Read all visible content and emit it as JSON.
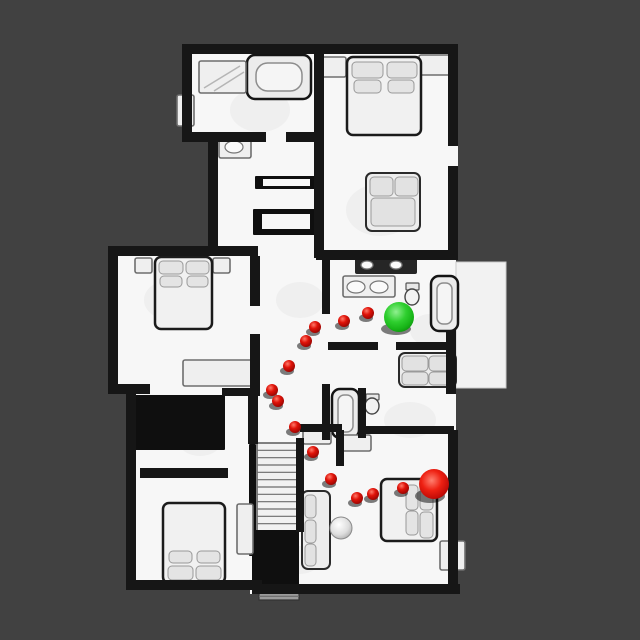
{
  "scene": {
    "background_color": "#414141",
    "canvas": {
      "width": 640,
      "height": 640
    }
  },
  "palette": {
    "floor": "#f7f7f7",
    "patio_floor": "#f2f2f2",
    "wall": "#161616",
    "furniture_fill": "#efefef",
    "furniture_stroke": "#6e6e6e",
    "bed_stroke": "#1b1b1b",
    "pillow_fill": "#e4e4e4",
    "pillow_stroke": "#999999",
    "dark_fill": "#0f0f0f",
    "tread_fill": "#f1f1f1",
    "smudge_fill": "#ebebeb",
    "waypoint_red": "#e01309",
    "waypoint_red_light": "#ff7a6a",
    "waypoint_red_dark": "#8f0503",
    "goal_red": "#dd1310",
    "start_green": "#2fcf2f",
    "start_green_light": "#90f090",
    "start_green_dark": "#0c8c0c",
    "shadow": "rgba(0,0,0,0.5)"
  },
  "markers": {
    "start": {
      "label": "start-position",
      "x": 399,
      "y": 317,
      "r": 15
    },
    "goal": {
      "label": "goal-position",
      "x": 434,
      "y": 484,
      "r": 15
    },
    "waypoint_radius": 6,
    "waypoints": [
      {
        "x": 368,
        "y": 313
      },
      {
        "x": 344,
        "y": 321
      },
      {
        "x": 315,
        "y": 327
      },
      {
        "x": 306,
        "y": 341
      },
      {
        "x": 289,
        "y": 366
      },
      {
        "x": 272,
        "y": 390
      },
      {
        "x": 278,
        "y": 401
      },
      {
        "x": 295,
        "y": 427
      },
      {
        "x": 313,
        "y": 452
      },
      {
        "x": 331,
        "y": 479
      },
      {
        "x": 357,
        "y": 498
      },
      {
        "x": 373,
        "y": 494
      },
      {
        "x": 403,
        "y": 488
      }
    ]
  },
  "floorplan": {
    "footprint": [
      [
        182,
        44,
        142,
        98
      ],
      [
        208,
        132,
        112,
        126
      ],
      [
        316,
        44,
        142,
        216
      ],
      [
        108,
        246,
        150,
        148
      ],
      [
        250,
        255,
        206,
        177
      ],
      [
        126,
        392,
        134,
        198
      ],
      [
        250,
        430,
        208,
        164
      ]
    ],
    "patio": [
      456,
      262,
      50,
      126
    ],
    "smudges": [
      [
        260,
        110,
        30,
        22
      ],
      [
        380,
        210,
        34,
        26
      ],
      [
        170,
        300,
        26,
        20
      ],
      [
        300,
        300,
        24,
        18
      ],
      [
        200,
        440,
        22,
        16
      ],
      [
        410,
        420,
        26,
        18
      ],
      [
        300,
        560,
        20,
        14
      ],
      [
        430,
        330,
        20,
        16
      ]
    ],
    "walls": [
      [
        182,
        44,
        142,
        10
      ],
      [
        182,
        44,
        10,
        96
      ],
      [
        182,
        132,
        36,
        10
      ],
      [
        208,
        138,
        10,
        118
      ],
      [
        214,
        132,
        52,
        10
      ],
      [
        286,
        132,
        38,
        10
      ],
      [
        316,
        44,
        142,
        10
      ],
      [
        448,
        44,
        10,
        102
      ],
      [
        448,
        166,
        10,
        94
      ],
      [
        314,
        50,
        10,
        90
      ],
      [
        314,
        140,
        10,
        118
      ],
      [
        316,
        250,
        140,
        10
      ],
      [
        108,
        246,
        150,
        10
      ],
      [
        108,
        246,
        10,
        148
      ],
      [
        108,
        384,
        42,
        10
      ],
      [
        250,
        256,
        10,
        50
      ],
      [
        250,
        334,
        10,
        62
      ],
      [
        446,
        330,
        10,
        64
      ],
      [
        322,
        258,
        8,
        56
      ],
      [
        328,
        342,
        50,
        8
      ],
      [
        396,
        342,
        58,
        8
      ],
      [
        300,
        424,
        42,
        8
      ],
      [
        360,
        426,
        94,
        8
      ],
      [
        322,
        384,
        8,
        56
      ],
      [
        358,
        388,
        8,
        50
      ],
      [
        448,
        430,
        10,
        160
      ],
      [
        252,
        584,
        208,
        10
      ],
      [
        126,
        392,
        10,
        198
      ],
      [
        126,
        580,
        136,
        10
      ],
      [
        140,
        468,
        88,
        10
      ],
      [
        296,
        438,
        8,
        94
      ],
      [
        222,
        388,
        38,
        8
      ],
      [
        248,
        392,
        10,
        52
      ],
      [
        336,
        430,
        8,
        36
      ]
    ],
    "furniture": [
      {
        "name": "bathtub-top-left",
        "kind": "tub",
        "x": 247,
        "y": 55,
        "w": 64,
        "h": 44,
        "inner": [
          256,
          63,
          46,
          28
        ]
      },
      {
        "name": "shower-top-left",
        "kind": "box",
        "x": 199,
        "y": 61,
        "w": 47,
        "h": 32,
        "lines": [
          [
            204,
            88,
            240,
            66
          ],
          [
            214,
            91,
            244,
            72
          ]
        ]
      },
      {
        "name": "cabinet-left-wall",
        "kind": "box",
        "x": 177,
        "y": 95,
        "w": 17,
        "h": 31
      },
      {
        "name": "vanity-top-left",
        "kind": "box",
        "x": 219,
        "y": 136,
        "w": 32,
        "h": 22,
        "ovals": [
          [
            234,
            147,
            9,
            6
          ]
        ]
      },
      {
        "name": "nightstand-master-left",
        "kind": "box",
        "x": 320,
        "y": 57,
        "w": 26,
        "h": 20
      },
      {
        "name": "nightstand-master-right",
        "kind": "box",
        "x": 419,
        "y": 55,
        "w": 34,
        "h": 20
      },
      {
        "name": "bed-master",
        "kind": "bed",
        "x": 347,
        "y": 57,
        "w": 74,
        "h": 78,
        "pillows": [
          [
            352,
            62,
            31,
            16
          ],
          [
            387,
            62,
            30,
            16
          ],
          [
            354,
            80,
            27,
            13
          ],
          [
            388,
            80,
            26,
            13
          ]
        ]
      },
      {
        "name": "armchair-master",
        "kind": "sofa",
        "x": 366,
        "y": 173,
        "w": 54,
        "h": 58,
        "cushions": [
          [
            370,
            177,
            23,
            19
          ],
          [
            395,
            177,
            23,
            19
          ],
          [
            371,
            198,
            44,
            28
          ]
        ]
      },
      {
        "name": "closet-door-frame-1",
        "kind": "frame",
        "x": 255,
        "y": 176,
        "w": 64,
        "h": 13,
        "inner": [
          263,
          179,
          47,
          7
        ]
      },
      {
        "name": "closet-door-frame-2",
        "kind": "frame",
        "x": 253,
        "y": 209,
        "w": 67,
        "h": 26,
        "inner": [
          262,
          214,
          48,
          15
        ]
      },
      {
        "name": "nightstand-left-room-a",
        "kind": "box",
        "x": 135,
        "y": 258,
        "w": 17,
        "h": 15
      },
      {
        "name": "nightstand-left-room-b",
        "kind": "box",
        "x": 213,
        "y": 258,
        "w": 17,
        "h": 15
      },
      {
        "name": "bed-left-room",
        "kind": "bed",
        "x": 155,
        "y": 257,
        "w": 57,
        "h": 72,
        "pillows": [
          [
            159,
            261,
            24,
            13
          ],
          [
            186,
            261,
            23,
            13
          ],
          [
            160,
            276,
            22,
            11
          ],
          [
            187,
            276,
            21,
            11
          ]
        ]
      },
      {
        "name": "dresser-left-room",
        "kind": "box",
        "x": 183,
        "y": 360,
        "w": 75,
        "h": 26
      },
      {
        "name": "counter-bedroom-side",
        "kind": "counter",
        "x": 355,
        "y": 257,
        "w": 62,
        "h": 17,
        "ovals": [
          [
            367,
            265,
            6,
            4
          ],
          [
            396,
            265,
            6,
            4
          ]
        ]
      },
      {
        "name": "vanity-double-sink",
        "kind": "box",
        "x": 343,
        "y": 276,
        "w": 52,
        "h": 21,
        "ovals": [
          [
            356,
            287,
            9,
            6
          ],
          [
            379,
            287,
            9,
            6
          ]
        ]
      },
      {
        "name": "toilet-central",
        "kind": "toilet",
        "bowl": [
          412,
          297,
          7,
          8
        ],
        "tank": [
          406,
          283,
          13,
          7
        ]
      },
      {
        "name": "bathtub-central-right",
        "kind": "tub",
        "x": 431,
        "y": 276,
        "w": 27,
        "h": 55,
        "inner": [
          437,
          283,
          15,
          41
        ]
      },
      {
        "name": "sofa-central-right",
        "kind": "sofa",
        "x": 399,
        "y": 353,
        "w": 57,
        "h": 34,
        "cushions": [
          [
            402,
            356,
            26,
            15
          ],
          [
            429,
            356,
            25,
            15
          ],
          [
            402,
            372,
            26,
            13
          ],
          [
            429,
            372,
            25,
            13
          ]
        ]
      },
      {
        "name": "bathtub-lower-center",
        "kind": "tub",
        "x": 332,
        "y": 389,
        "w": 27,
        "h": 49,
        "inner": [
          338,
          395,
          15,
          37
        ]
      },
      {
        "name": "toilet-lower",
        "kind": "toilet",
        "bowl": [
          372,
          406,
          7,
          8
        ],
        "tank": [
          366,
          394,
          13,
          6
        ]
      },
      {
        "name": "wardrobe-dark-left",
        "kind": "dark",
        "x": 132,
        "y": 395,
        "w": 93,
        "h": 55
      },
      {
        "name": "staircase",
        "kind": "stairs",
        "x": 257,
        "y": 443,
        "w": 40,
        "h": 88,
        "steps": 12
      },
      {
        "name": "stair-banister",
        "kind": "dark",
        "x": 249,
        "y": 444,
        "w": 7,
        "h": 112
      },
      {
        "name": "under-stairs-dark",
        "kind": "dark",
        "x": 252,
        "y": 530,
        "w": 47,
        "h": 58
      },
      {
        "name": "porch-steps",
        "kind": "stairs",
        "x": 259,
        "y": 589,
        "w": 40,
        "h": 11,
        "steps": 3,
        "fill": "#9b9b9b"
      },
      {
        "name": "vanity-near-stairs",
        "kind": "box",
        "x": 303,
        "y": 430,
        "w": 28,
        "h": 14
      },
      {
        "name": "dresser-bottom-left",
        "kind": "box",
        "x": 237,
        "y": 504,
        "w": 16,
        "h": 50
      },
      {
        "name": "bed-bottom-left",
        "kind": "bed",
        "x": 163,
        "y": 503,
        "w": 62,
        "h": 80,
        "pillows": [
          [
            168,
            566,
            25,
            14
          ],
          [
            196,
            566,
            25,
            14
          ],
          [
            169,
            551,
            23,
            12
          ],
          [
            197,
            551,
            23,
            12
          ]
        ]
      },
      {
        "name": "sofa-bottom-center",
        "kind": "sofa",
        "x": 302,
        "y": 491,
        "w": 28,
        "h": 78,
        "cushions": [
          [
            305,
            495,
            11,
            23
          ],
          [
            305,
            520,
            11,
            23
          ],
          [
            305,
            544,
            11,
            22
          ]
        ]
      },
      {
        "name": "globe-decor",
        "kind": "circle",
        "x": 341,
        "y": 528,
        "r": 11
      },
      {
        "name": "dresser-bottom-right",
        "kind": "box",
        "x": 341,
        "y": 435,
        "w": 30,
        "h": 16
      },
      {
        "name": "bed-bottom-right",
        "kind": "bed",
        "x": 381,
        "y": 479,
        "w": 56,
        "h": 62,
        "pillows": [
          [
            420,
            483,
            13,
            27
          ],
          [
            420,
            512,
            13,
            26
          ],
          [
            406,
            485,
            12,
            25
          ],
          [
            406,
            511,
            12,
            24
          ]
        ]
      },
      {
        "name": "chair-bottom-right",
        "kind": "box",
        "x": 440,
        "y": 541,
        "w": 25,
        "h": 29
      }
    ]
  }
}
